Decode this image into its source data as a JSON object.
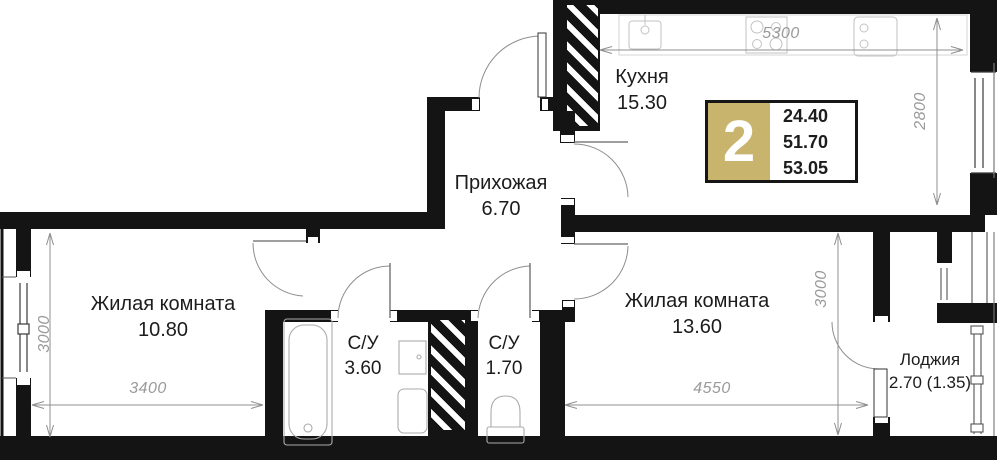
{
  "badge": {
    "room_count": "2",
    "areas": [
      "24.40",
      "51.70",
      "53.05"
    ],
    "accent_color": "#c9b46e"
  },
  "rooms": {
    "kitchen": {
      "name": "Кухня",
      "area": "15.30"
    },
    "hallway": {
      "name": "Прихожая",
      "area": "6.70"
    },
    "living1": {
      "name": "Жилая комната",
      "area": "10.80"
    },
    "living2": {
      "name": "Жилая комната",
      "area": "13.60"
    },
    "bath1": {
      "name": "С/У",
      "area": "3.60"
    },
    "bath2": {
      "name": "С/У",
      "area": "1.70"
    },
    "loggia": {
      "name": "Лоджия",
      "area": "2.70 (1.35)"
    }
  },
  "dimensions": {
    "kitchen_width": "5300",
    "kitchen_depth": "2800",
    "living1_depth": "3000",
    "living1_width": "3400",
    "living2_width": "4550",
    "living2_depth": "3000"
  },
  "colors": {
    "wall": "#141414",
    "dim_text": "#9a9a9a",
    "label_text": "#1c1c1c"
  }
}
